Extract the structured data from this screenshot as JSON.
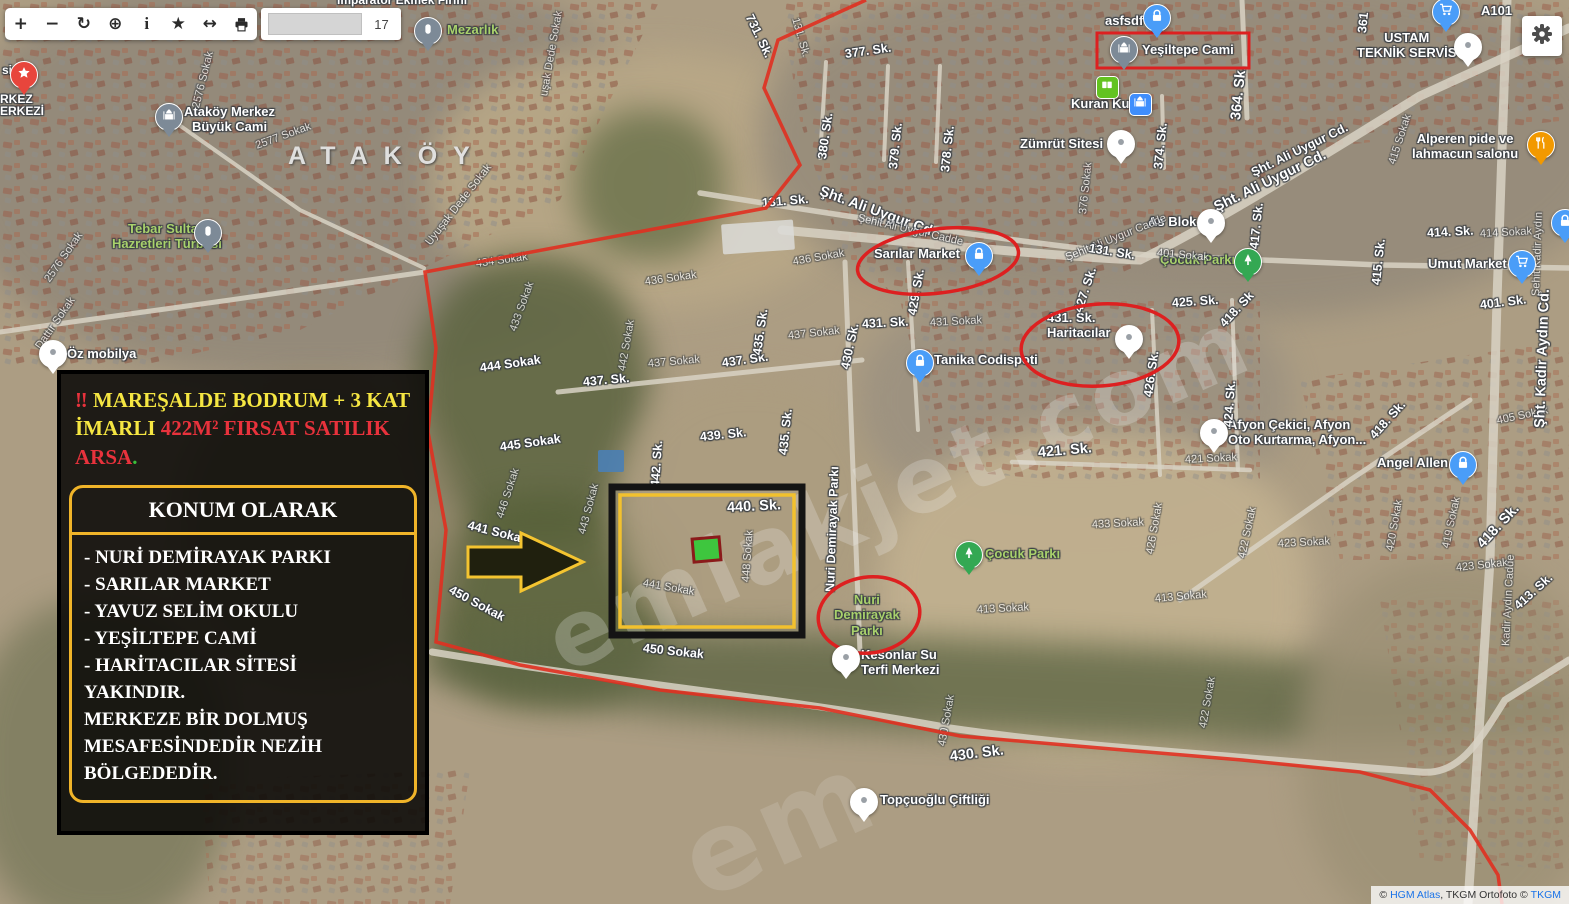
{
  "colors": {
    "accent_red": "#e03020",
    "accent_yellow": "#f2c12e",
    "plot_green": "#3ec63e",
    "pin_blue": "#4a9df8",
    "label_green": "#a9d16c",
    "link_blue": "#1a73e8"
  },
  "toolbar": {
    "buttons": [
      {
        "name": "zoom-in-button",
        "glyph": "+"
      },
      {
        "name": "zoom-out-button",
        "glyph": "−"
      },
      {
        "name": "refresh-button",
        "glyph": "↻"
      },
      {
        "name": "locate-button",
        "glyph": "⊕"
      },
      {
        "name": "info-button",
        "glyph": "i"
      },
      {
        "name": "favorite-button",
        "glyph": "★"
      },
      {
        "name": "measure-button",
        "glyph": "↔"
      },
      {
        "name": "print-button",
        "glyph": "printer-icon"
      }
    ],
    "zoom_level": "17"
  },
  "info_panel": {
    "title_segments": [
      [
        "‼ ",
        "red"
      ],
      [
        "MAREŞALDE BODRUM + 3 KAT ",
        "yellow"
      ],
      [
        "İMARLI ",
        "yellow"
      ],
      [
        "422M² FIRSAT SATILIK ",
        "red"
      ],
      [
        "ARSA",
        "red"
      ],
      [
        ".",
        "green"
      ]
    ],
    "konum_header": "KONUM OLARAK",
    "list_lines": [
      "- NURİ DEMİRAYAK PARKI",
      "- SARILAR MARKET",
      "- YAVUZ SELİM OKULU",
      "- YEŞİLTEPE CAMİ",
      "- HARİTACILAR SİTESİ",
      "YAKINDIR.",
      "MERKEZE BİR DOLMUŞ",
      "MESAFESİNDEDİR NEZİH",
      "BÖLGEDEDİR."
    ]
  },
  "map": {
    "region_label": "ATAKÖY",
    "watermark": "emlakjet.com",
    "watermark2": "em",
    "pois": [
      {
        "label": "Mezarlık",
        "lx": 447,
        "ly": 22,
        "px": 427,
        "py": 30,
        "type": "gray-tomb",
        "lcolor": "green",
        "icon": "cemetery-icon"
      },
      {
        "label": "Ataköy Merkez\nBüyük Cami",
        "lx": 184,
        "ly": 104,
        "px": 168,
        "py": 116,
        "type": "gray-mosque",
        "align": "center",
        "icon": "mosque-icon"
      },
      {
        "label": "Tebar Sultan\nHazretleri Türbesi",
        "lx": 112,
        "ly": 221,
        "px": 207,
        "py": 232,
        "type": "gray-tomb",
        "lcolor": "green",
        "align": "center",
        "icon": "tomb-icon"
      },
      {
        "label": "Öz mobilya",
        "lx": 67,
        "ly": 346,
        "px": 52,
        "py": 353,
        "type": "white-dot",
        "icon": "place-icon"
      },
      {
        "label": "",
        "px": 23,
        "py": 74,
        "type": "red-star",
        "icon": "star-icon"
      },
      {
        "label": "asfsdf",
        "lx": 1105,
        "ly": 13,
        "px": 1156,
        "py": 17,
        "type": "blue-lock",
        "icon": "lock-icon"
      },
      {
        "label": "Yeşiltepe Cami",
        "lx": 1142,
        "ly": 42,
        "px": 1123,
        "py": 49,
        "type": "gray-mosque",
        "icon": "mosque-icon"
      },
      {
        "label": "Kuran Kursu",
        "lx": 1071,
        "ly": 96,
        "px": 1106,
        "py": 86,
        "type": "green-square",
        "icon": "book-icon"
      },
      {
        "label": "",
        "px": 1139,
        "py": 103,
        "type": "blue-square",
        "icon": "mosque-icon"
      },
      {
        "label": "Zümrüt Sitesi",
        "lx": 1020,
        "ly": 136,
        "px": 1120,
        "py": 143,
        "type": "white-dot",
        "icon": "place-icon"
      },
      {
        "label": "USTAM\nTEKNİK SERVİS",
        "lx": 1357,
        "ly": 30,
        "px": 1467,
        "py": 46,
        "type": "white-dot",
        "align": "center",
        "icon": "place-icon"
      },
      {
        "label": "A101",
        "lx": 1481,
        "ly": 3,
        "px": 1445,
        "py": 11,
        "type": "blue-cart",
        "icon": "cart-icon"
      },
      {
        "label": "Alperen pide ve\nlahmacun salonu",
        "lx": 1412,
        "ly": 131,
        "px": 1540,
        "py": 144,
        "type": "orange-food",
        "align": "center",
        "icon": "restaurant-icon"
      },
      {
        "label": "Sarılar Market",
        "lx": 874,
        "ly": 246,
        "px": 978,
        "py": 255,
        "type": "blue-lock",
        "icon": "lock-icon"
      },
      {
        "label": "As Blok",
        "lx": 1148,
        "ly": 214,
        "px": 1210,
        "py": 222,
        "type": "white-dot",
        "icon": "place-icon"
      },
      {
        "label": "Çocuk Parkı",
        "lx": 1160,
        "ly": 252,
        "px": 1247,
        "py": 261,
        "type": "green-tree",
        "lcolor": "green",
        "icon": "tree-icon"
      },
      {
        "label": "Umut Market",
        "lx": 1428,
        "ly": 256,
        "px": 1521,
        "py": 263,
        "type": "blue-cart",
        "icon": "cart-icon"
      },
      {
        "label": "431. Sk.\nHaritacılar",
        "lx": 1047,
        "ly": 310,
        "px": 1128,
        "py": 338,
        "type": "white-dot",
        "icon": "place-icon"
      },
      {
        "label": "Tanika Codispoti",
        "lx": 934,
        "ly": 352,
        "px": 919,
        "py": 362,
        "type": "blue-lock",
        "icon": "lock-icon"
      },
      {
        "label": "Afyon Çekici, Afyon\nOto Kurtarma, Afyon...",
        "lx": 1228,
        "ly": 417,
        "px": 1213,
        "py": 432,
        "type": "white-dot",
        "icon": "place-icon"
      },
      {
        "label": "Angel Allen",
        "lx": 1377,
        "ly": 455,
        "px": 1462,
        "py": 464,
        "type": "blue-lock",
        "icon": "lock-icon"
      },
      {
        "label": "Çocuk Parkı",
        "lx": 985,
        "ly": 546,
        "px": 968,
        "py": 554,
        "type": "green-tree",
        "lcolor": "green",
        "icon": "tree-icon"
      },
      {
        "label": "Nuri\nDemirayak\nParkı",
        "lx": 834,
        "ly": 592,
        "lcolor": "green",
        "align": "center"
      },
      {
        "label": "Kesonlar Su\nTerfi Merkezi",
        "lx": 861,
        "ly": 647,
        "px": 845,
        "py": 658,
        "type": "white-dot",
        "icon": "place-icon"
      },
      {
        "label": "Topçuoğlu Çiftliği",
        "lx": 880,
        "ly": 792,
        "px": 863,
        "py": 801,
        "type": "white-dot",
        "icon": "place-icon"
      },
      {
        "label": "",
        "px": 1564,
        "py": 222,
        "type": "blue-lock",
        "icon": "lock-icon"
      }
    ],
    "street_labels": [
      [
        "731. Sk.",
        749,
        8,
        64,
        ""
      ],
      [
        "131. Sk.",
        795,
        12,
        74,
        "f"
      ],
      [
        "377. Sk.",
        845,
        47,
        -8,
        ""
      ],
      [
        "380. Sk.",
        822,
        152,
        -82,
        ""
      ],
      [
        "379. Sk.",
        893,
        162,
        -84,
        ""
      ],
      [
        "378. Sk.",
        945,
        165,
        -84,
        ""
      ],
      [
        "131. Sk.",
        762,
        196,
        -5,
        ""
      ],
      [
        "Şht. Ali Uygur Cd",
        820,
        183,
        20,
        "b"
      ],
      [
        "Şehit Ali Uygur Cadde",
        858,
        212,
        13,
        "f"
      ],
      [
        "Şehit Ali Uygur Cadde",
        1066,
        252,
        -22,
        "f"
      ],
      [
        "Şht. Ali Uygur Cd.",
        1215,
        200,
        -26,
        "b"
      ],
      [
        "Şht. Ali Uygur Cd.",
        1252,
        166,
        -26,
        ""
      ],
      [
        "364. Sk.",
        1236,
        112,
        -84,
        "b"
      ],
      [
        "374. Sk.",
        1158,
        162,
        -84,
        ""
      ],
      [
        "361",
        1362,
        26,
        -84,
        ""
      ],
      [
        "376 Sokak",
        1083,
        208,
        -84,
        "f"
      ],
      [
        "417. Sk.",
        1254,
        242,
        -84,
        ""
      ],
      [
        "425. Sk.",
        1172,
        296,
        -4,
        ""
      ],
      [
        "426. Sk.",
        1148,
        390,
        -82,
        ""
      ],
      [
        "424. Sk.",
        1228,
        420,
        -86,
        ""
      ],
      [
        "418. Sk",
        1222,
        318,
        -47,
        ""
      ],
      [
        "131. Sk.",
        1089,
        241,
        9,
        ""
      ],
      [
        "401 Sokak",
        1157,
        247,
        5,
        "f"
      ],
      [
        "429. Sk.",
        912,
        308,
        -80,
        ""
      ],
      [
        "430. Sk.",
        845,
        362,
        -78,
        ""
      ],
      [
        "431. Sk.",
        862,
        317,
        -3,
        ""
      ],
      [
        "431 Sokak",
        930,
        317,
        -3,
        "f"
      ],
      [
        "427. Sk.",
        1078,
        305,
        -72,
        ""
      ],
      [
        "421. Sk.",
        1038,
        445,
        -5,
        "b"
      ],
      [
        "421 Sokak",
        1185,
        454,
        -3,
        "f"
      ],
      [
        "433 Sokak",
        1092,
        519,
        -3,
        "f"
      ],
      [
        "426 Sokak",
        1150,
        548,
        -80,
        "f"
      ],
      [
        "422 Sokak",
        1242,
        552,
        -78,
        "f"
      ],
      [
        "422 Sokak",
        1203,
        722,
        -80,
        "f"
      ],
      [
        "413 Sokak",
        977,
        604,
        -3,
        "f"
      ],
      [
        "413 Sokak",
        1155,
        593,
        -5,
        "f"
      ],
      [
        "430 Sokak",
        942,
        740,
        -80,
        "f"
      ],
      [
        "430. Sk.",
        950,
        749,
        -7,
        "b"
      ],
      [
        "Nuri Demirayak Parkı",
        830,
        585,
        -88,
        ""
      ],
      [
        "437. Sk.",
        583,
        375,
        -5,
        ""
      ],
      [
        "437 Sokak",
        648,
        358,
        -5,
        "f"
      ],
      [
        "437. Sk.",
        722,
        356,
        -8,
        ""
      ],
      [
        "437 Sokak",
        788,
        330,
        -6,
        "f"
      ],
      [
        "436 Sokak",
        645,
        276,
        -8,
        "f"
      ],
      [
        "436 Sokak",
        793,
        256,
        -10,
        "f"
      ],
      [
        "434 Sokak",
        476,
        258,
        -8,
        "f"
      ],
      [
        "433 Sokak",
        513,
        325,
        -70,
        "f"
      ],
      [
        "444 Sokak",
        480,
        361,
        -8,
        ""
      ],
      [
        "442 Sokak",
        622,
        365,
        -80,
        "f"
      ],
      [
        "442. Sk.",
        655,
        480,
        -86,
        ""
      ],
      [
        "435. Sk.",
        757,
        348,
        -82,
        ""
      ],
      [
        "435. Sk.",
        783,
        448,
        -84,
        ""
      ],
      [
        "439. Sk.",
        700,
        430,
        -6,
        ""
      ],
      [
        "445 Sokak",
        500,
        440,
        -8,
        ""
      ],
      [
        "446 Sokak",
        500,
        512,
        -72,
        "f"
      ],
      [
        "441 Sokak",
        468,
        518,
        14,
        ""
      ],
      [
        "441 Sokak",
        643,
        577,
        10,
        "f"
      ],
      [
        "450 Sokak",
        450,
        582,
        28,
        ""
      ],
      [
        "450 Sokak",
        643,
        641,
        6,
        ""
      ],
      [
        "443 Sokak",
        582,
        528,
        -75,
        "f"
      ],
      [
        "448 Sokak",
        746,
        576,
        -86,
        "f"
      ],
      [
        "440. Sk.",
        727,
        500,
        -3,
        "b"
      ],
      [
        "414. Sk.",
        1427,
        226,
        -3,
        ""
      ],
      [
        "414 Sokak",
        1480,
        228,
        -3,
        "f"
      ],
      [
        "401. Sk.",
        1480,
        298,
        -7,
        ""
      ],
      [
        "415. Sk.",
        1376,
        278,
        -84,
        ""
      ],
      [
        "415 Sokak",
        1392,
        158,
        -72,
        "f"
      ],
      [
        "405 Sokak",
        1497,
        415,
        -12,
        "f"
      ],
      [
        "418. Sk.",
        1372,
        430,
        -48,
        ""
      ],
      [
        "418. Sk.",
        1480,
        538,
        -47,
        "b"
      ],
      [
        "413. Sk.",
        1516,
        600,
        -42,
        ""
      ],
      [
        "Şht. Kadir Aydın Cd.",
        1540,
        420,
        -88,
        "b"
      ],
      [
        "Şehit Kadir Aydın",
        1536,
        290,
        -88,
        "f"
      ],
      [
        "Kadir Aydın Cadde",
        1506,
        640,
        -87,
        "f"
      ],
      [
        "423 Sokak",
        1278,
        538,
        -3,
        "f"
      ],
      [
        "423 Sokak",
        1456,
        562,
        -6,
        "f"
      ],
      [
        "420 Sokak",
        1390,
        545,
        -80,
        "f"
      ],
      [
        "419 Sokak",
        1446,
        542,
        -78,
        "f"
      ],
      [
        "2577 Sokak",
        256,
        140,
        -20,
        "f"
      ],
      [
        "2576 Sokak",
        196,
        102,
        -76,
        "f"
      ],
      [
        "2576 Sokak",
        47,
        275,
        -55,
        "f"
      ],
      [
        "Dattır Sokak",
        38,
        342,
        -55,
        "f"
      ],
      [
        "Uyuşak Dede Sokak",
        428,
        238,
        -52,
        "f"
      ],
      [
        "uşak Dede Sokak",
        544,
        90,
        -80,
        "f"
      ]
    ],
    "partial_labels": [
      {
        "text": "İmparator Ekmek Fırını",
        "x": 337,
        "y": -7
      },
      {
        "text": "si",
        "x": 2,
        "y": 63
      },
      {
        "text": "RKEZ",
        "x": 0,
        "y": 92
      },
      {
        "text": "ERKEZİ",
        "x": 0,
        "y": 104
      }
    ]
  },
  "attribution": {
    "segments": [
      [
        "© ",
        "t"
      ],
      [
        "HGM Atlas",
        "l"
      ],
      [
        ", TKGM Ortofoto © ",
        "t"
      ],
      [
        "TKGM",
        "l"
      ]
    ]
  }
}
